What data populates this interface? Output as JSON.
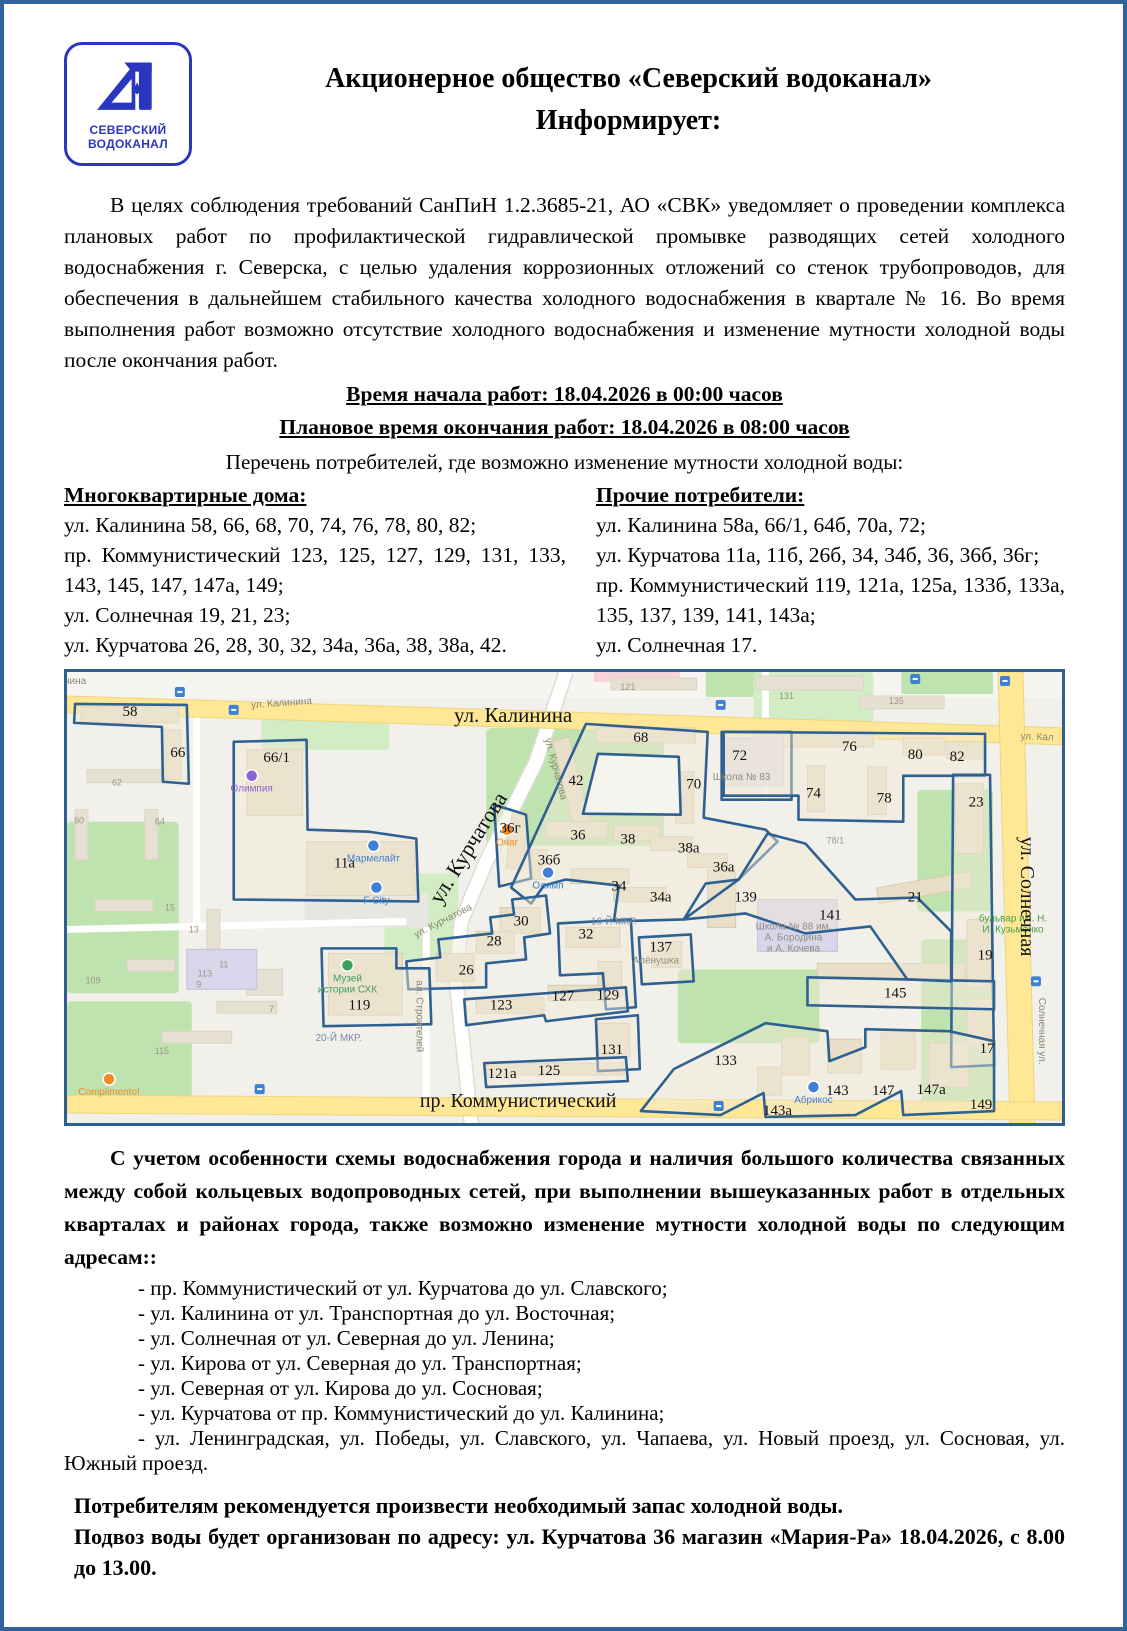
{
  "doc": {
    "logo": {
      "line1": "СЕВЕРСКИЙ",
      "line2": "ВОДОКАНАЛ"
    },
    "title_line1": "Акционерное общество «Северский водоканал»",
    "title_line2": "Информирует:",
    "intro": "В целях соблюдения требований СанПиН 1.2.3685-21, АО «СВК» уведомляет о проведении комплекса плановых работ по профилактической гидравлической промывке разводящих сетей холодного водоснабжения г. Северска, с целью удаления коррозионных отложений со стенок трубопроводов, для обеспечения в дальнейшем стабильного качества холодного водоснабжения в квартале № 16. Во время выполнения работ возможно отсутствие холодного водоснабжения и изменение мутности холодной воды после окончания работ.",
    "work_start": "Время начала работ: 18.04.2026 в 00:00 часов",
    "work_end": "Плановое время окончания работ: 18.04.2026 в 08:00 часов",
    "list_intro": "Перечень потребителей, где возможно изменение мутности холодной воды:",
    "apartments_heading": "Многоквартирные дома:",
    "apartments": [
      "ул. Калинина 58, 66, 68, 70, 74, 76, 78, 80, 82;",
      "пр. Коммунистический 123, 125, 127, 129, 131, 133, 143, 145, 147, 147а, 149;",
      "ул. Солнечная 19, 21, 23;",
      "ул. Курчатова 26, 28, 30, 32, 34а, 36а, 38, 38а, 42."
    ],
    "others_heading": "Прочие потребители:",
    "others": [
      "ул. Калинина 58а, 66/1, 64б, 70а, 72;",
      "ул. Курчатова 11а, 11б, 26б, 34, 34б, 36, 36б, 36г;",
      "пр. Коммунистический 119, 121а, 125а, 133б, 133а, 135, 137, 139, 141, 143а;",
      "ул. Солнечная 17."
    ],
    "note": "С учетом особенности схемы водоснабжения города и наличия большого количества связанных между собой кольцевых водопроводных сетей, при выполнении вышеуказанных работ в отдельных кварталах и районах города, также возможно изменение мутности холодной воды по следующим адресам::",
    "affected_streets": [
      "- пр. Коммунистический от ул. Курчатова до ул. Славского;",
      "- ул. Калинина от ул. Транспортная до ул. Восточная;",
      "- ул. Солнечная от ул. Северная до ул. Ленина;",
      "- ул. Кирова от ул. Северная до ул. Транспортная;",
      "- ул. Северная от ул. Кирова до ул. Сосновая;",
      "- ул. Курчатова от пр. Коммунистический до ул. Калинина;",
      "- ул. Ленинградская, ул. Победы, ул. Славского, ул. Чапаева, ул. Новый проезд, ул. Сосновая, ул. Южный проезд."
    ],
    "advice": "Потребителям рекомендуется произвести необходимый запас холодной воды.",
    "supply": "Подвоз воды будет организован по адресу: ул. Курчатова 36 магазин «Мария-Ра» 18.04.2026, с 8.00 до 13.00."
  },
  "map": {
    "colors": {
      "zone_outline": "#2e6191",
      "frame": "#2e5f8f",
      "road_yellow": "#ffe895",
      "green": "#bfe3ae",
      "building": "#e9dfc8",
      "poi_blue": "#3f7fd6",
      "poi_orange": "#f28b1f",
      "poi_purple": "#8a63d2",
      "poi_green": "#3e9d5c"
    },
    "numbers": [
      {
        "t": "58",
        "x": 63,
        "y": 44
      },
      {
        "t": "66",
        "x": 111,
        "y": 85
      },
      {
        "t": "66/1",
        "x": 210,
        "y": 90
      },
      {
        "t": "68",
        "x": 575,
        "y": 70
      },
      {
        "t": "72",
        "x": 674,
        "y": 88
      },
      {
        "t": "76",
        "x": 784,
        "y": 79
      },
      {
        "t": "80",
        "x": 850,
        "y": 87
      },
      {
        "t": "82",
        "x": 892,
        "y": 89
      },
      {
        "t": "42",
        "x": 510,
        "y": 113
      },
      {
        "t": "70",
        "x": 628,
        "y": 117
      },
      {
        "t": "74",
        "x": 748,
        "y": 126
      },
      {
        "t": "78",
        "x": 819,
        "y": 131
      },
      {
        "t": "23",
        "x": 911,
        "y": 135
      },
      {
        "t": "36г",
        "x": 444,
        "y": 161
      },
      {
        "t": "36",
        "x": 512,
        "y": 168
      },
      {
        "t": "38",
        "x": 562,
        "y": 172
      },
      {
        "t": "38а",
        "x": 623,
        "y": 181
      },
      {
        "t": "11а",
        "x": 278,
        "y": 196
      },
      {
        "t": "36б",
        "x": 483,
        "y": 193
      },
      {
        "t": "36а",
        "x": 658,
        "y": 200
      },
      {
        "t": "34",
        "x": 553,
        "y": 219
      },
      {
        "t": "34а",
        "x": 595,
        "y": 230
      },
      {
        "t": "139",
        "x": 680,
        "y": 230
      },
      {
        "t": "21",
        "x": 850,
        "y": 230
      },
      {
        "t": "141",
        "x": 765,
        "y": 248
      },
      {
        "t": "137",
        "x": 595,
        "y": 280
      },
      {
        "t": "30",
        "x": 455,
        "y": 254
      },
      {
        "t": "28",
        "x": 428,
        "y": 274
      },
      {
        "t": "32",
        "x": 520,
        "y": 267
      },
      {
        "t": "26",
        "x": 400,
        "y": 303
      },
      {
        "t": "129",
        "x": 542,
        "y": 328
      },
      {
        "t": "19",
        "x": 920,
        "y": 288
      },
      {
        "t": "145",
        "x": 830,
        "y": 326
      },
      {
        "t": "123",
        "x": 435,
        "y": 338
      },
      {
        "t": "127",
        "x": 497,
        "y": 329
      },
      {
        "t": "131",
        "x": 546,
        "y": 383
      },
      {
        "t": "17",
        "x": 922,
        "y": 382
      },
      {
        "t": "119",
        "x": 293,
        "y": 338
      },
      {
        "t": "133",
        "x": 660,
        "y": 394
      },
      {
        "t": "143",
        "x": 772,
        "y": 424
      },
      {
        "t": "147",
        "x": 818,
        "y": 424
      },
      {
        "t": "147а",
        "x": 866,
        "y": 423
      },
      {
        "t": "149",
        "x": 916,
        "y": 438
      },
      {
        "t": "143а",
        "x": 712,
        "y": 444
      },
      {
        "t": "121а",
        "x": 436,
        "y": 407
      },
      {
        "t": "125",
        "x": 483,
        "y": 404
      }
    ],
    "faint_numbers": [
      {
        "t": "121",
        "x": 562,
        "y": 18
      },
      {
        "t": "131",
        "x": 721,
        "y": 27
      },
      {
        "t": "135",
        "x": 831,
        "y": 32
      },
      {
        "t": "62",
        "x": 50,
        "y": 114
      },
      {
        "t": "60",
        "x": 12,
        "y": 152
      },
      {
        "t": "64",
        "x": 93,
        "y": 153
      },
      {
        "t": "78/1",
        "x": 770,
        "y": 172
      },
      {
        "t": "15",
        "x": 103,
        "y": 239
      },
      {
        "t": "13",
        "x": 127,
        "y": 261
      },
      {
        "t": "11",
        "x": 157,
        "y": 296
      },
      {
        "t": "9",
        "x": 132,
        "y": 316
      },
      {
        "t": "7",
        "x": 205,
        "y": 341
      },
      {
        "t": "113",
        "x": 138,
        "y": 305
      },
      {
        "t": "109",
        "x": 26,
        "y": 312
      },
      {
        "t": "115",
        "x": 95,
        "y": 383
      }
    ],
    "street_labels_large": [
      {
        "t": "ул. Калинина",
        "x": 447,
        "y": 50,
        "rot": 0,
        "size": 21
      },
      {
        "t": "ул. Курчатова",
        "x": 408,
        "y": 180,
        "rot": -58,
        "size": 22
      },
      {
        "t": "ул. Солнечная",
        "x": 956,
        "y": 225,
        "rot": 90,
        "size": 20
      },
      {
        "t": "пр. Коммунистический",
        "x": 452,
        "y": 436,
        "rot": 0,
        "size": 20
      }
    ],
    "street_labels_small": [
      {
        "t": "нина",
        "x": 8,
        "y": 12,
        "rot": 0,
        "cls": ""
      },
      {
        "t": "ул. Калинина",
        "x": 215,
        "y": 34,
        "rot": -4,
        "cls": ""
      },
      {
        "t": "ул. Кал",
        "x": 972,
        "y": 68,
        "rot": 2,
        "cls": ""
      },
      {
        "t": "ул. Курчатова",
        "x": 487,
        "y": 98,
        "rot": 75,
        "cls": ""
      },
      {
        "t": "ул. Курчатова",
        "x": 378,
        "y": 252,
        "rot": -27,
        "cls": ""
      },
      {
        "t": "ал. Строителей",
        "x": 350,
        "y": 345,
        "rot": 90,
        "cls": ""
      },
      {
        "t": "Солнечная ул.",
        "x": 974,
        "y": 360,
        "rot": 90,
        "cls": ""
      },
      {
        "t": "20-Й МКР.",
        "x": 272,
        "y": 370,
        "rot": 0,
        "cls": "blue"
      },
      {
        "t": "16-Й МКР.",
        "x": 548,
        "y": 253,
        "rot": 0,
        "cls": "blue"
      }
    ],
    "pois": [
      {
        "t": "Олимпия",
        "x": 185,
        "y": 120,
        "color": "#8a63d2",
        "dot": true
      },
      {
        "t": "Мармелайт",
        "x": 307,
        "y": 190,
        "color": "#3f7fd6",
        "dot": true
      },
      {
        "t": "F City",
        "x": 310,
        "y": 232,
        "color": "#3f7fd6",
        "dot": true
      },
      {
        "t": "Очаг",
        "x": 441,
        "y": 174,
        "color": "#f28b1f",
        "dot": true
      },
      {
        "t": "Олимп",
        "x": 482,
        "y": 217,
        "color": "#3f7fd6",
        "dot": true
      },
      {
        "t": "Абрикос",
        "x": 748,
        "y": 432,
        "color": "#3f7fd6",
        "dot": true
      },
      {
        "t": "Complimento!",
        "x": 42,
        "y": 424,
        "color": "#f28b1f",
        "dot": true
      },
      {
        "t": "Алёнушка",
        "x": 590,
        "y": 292,
        "color": "#8d8d80",
        "dot": false
      },
      {
        "t": "Школа № 83",
        "x": 676,
        "y": 108,
        "color": "#8d8d80",
        "dot": false
      },
      {
        "lines": [
          "Школа № 88 им.",
          "А. Бородина",
          "и А. Кочева"
        ],
        "x": 728,
        "y": 258,
        "color": "#8d8d80",
        "dot": false
      },
      {
        "lines": [
          "Музей",
          "истории СХК"
        ],
        "x": 281,
        "y": 310,
        "color": "#3e9d5c",
        "dot": true
      },
      {
        "lines": [
          "бульвар им. Н.",
          "И. Кузьменко"
        ],
        "x": 948,
        "y": 250,
        "color": "#4a9e43",
        "dot": false
      }
    ]
  }
}
